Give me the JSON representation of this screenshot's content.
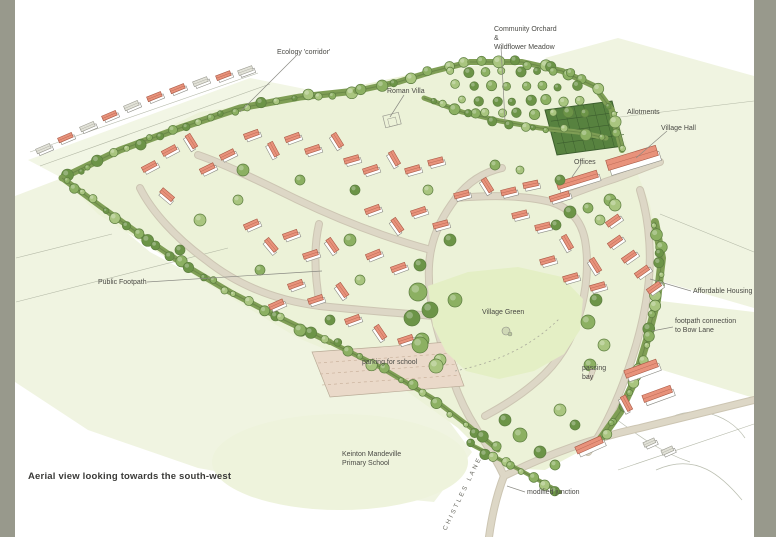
{
  "page": {
    "caption": "Aerial view looking towards the south-west",
    "frame_color": "#98998c",
    "paper_color": "#ffffff"
  },
  "palette": {
    "field_light": "#f0f4e1",
    "site_wash": "#ecf2d8",
    "lawn": "#e4efc5",
    "hedge": "#7f9e55",
    "hedge_dark": "#55713a",
    "tree_light": "#a9c57f",
    "tree_mid": "#8cb062",
    "tree_dark": "#6c9447",
    "roof_salmon": "#e8927b",
    "roof_line": "#a85945",
    "roof_gray": "#e2e2d8",
    "wall": "#ffffff",
    "road": "#ddd7c6",
    "road_edge": "#ccc5b2",
    "parking": "#ead9c9",
    "allotment": "#57823f",
    "ink": "#8b8b84",
    "label_ink": "#4a4a45"
  },
  "annotations": [
    {
      "id": "ecology-corridor",
      "text": "Ecology 'corridor'"
    },
    {
      "id": "community-orchard",
      "text": "Community Orchard\n&\nWildflower Meadow"
    },
    {
      "id": "roman-villa",
      "text": "Roman Villa"
    },
    {
      "id": "allotments",
      "text": "Allotments"
    },
    {
      "id": "village-hall",
      "text": "Village Hall"
    },
    {
      "id": "offices",
      "text": "Offices"
    },
    {
      "id": "public-footpath",
      "text": "Public Footpath"
    },
    {
      "id": "affordable-housing",
      "text": "Affordable Housing"
    },
    {
      "id": "footpath-connection",
      "text": "footpath connection\nto Bow Lane"
    },
    {
      "id": "village-green",
      "text": "Village Green"
    },
    {
      "id": "parking-for-school",
      "text": "parking for school"
    },
    {
      "id": "passing-bay",
      "text": "passing\nbay"
    },
    {
      "id": "primary-school",
      "text": "Keinton Mandeville\nPrimary School"
    },
    {
      "id": "modified-junction",
      "text": "modified junction"
    },
    {
      "id": "chistles-lane",
      "text": "CHISTLES LANE"
    }
  ]
}
